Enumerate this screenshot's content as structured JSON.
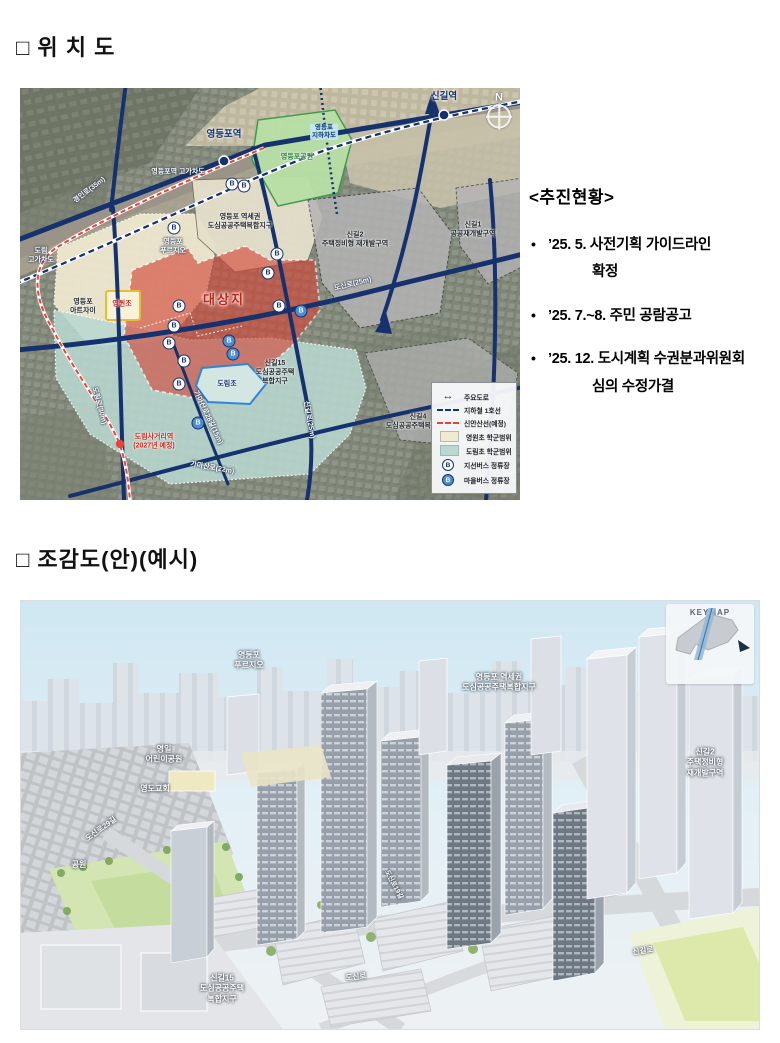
{
  "page": {
    "background": "#ffffff"
  },
  "section1": {
    "title": "□ 위 치 도"
  },
  "section2": {
    "title": "□ 조감도(안)(예시)"
  },
  "status": {
    "heading": "<추진현황>",
    "items": [
      {
        "line1": "’25. 5. 사전기획 가이드라인",
        "line2": "확정"
      },
      {
        "line1": "’25. 7.~8. 주민 공람공고",
        "line2": ""
      },
      {
        "line1": "’25. 12. 도시계획 수권분과위원회",
        "line2": "심의 수정가결"
      }
    ]
  },
  "map": {
    "compass_n": "N",
    "labels": [
      {
        "text": "영등포역"
      },
      {
        "text": "신길역"
      },
      {
        "text": "영등포역 고가차도"
      },
      {
        "text": "경인로(35m)"
      },
      {
        "text": "도림\n고가차도"
      },
      {
        "text": "영등포\n지하차도"
      },
      {
        "text": "영등포공원"
      },
      {
        "text": "영등포 역세권\n도심공공주택복합지구"
      },
      {
        "text": "영등포\n푸르지오"
      },
      {
        "text": "대상지"
      },
      {
        "text": "신길2\n주택정비형 재개발구역"
      },
      {
        "text": "신길1\n공공재개발구역"
      },
      {
        "text": "영원초"
      },
      {
        "text": "도림초"
      },
      {
        "text": "신길15\n도심공공주택\n복합지구"
      },
      {
        "text": "신길4\n도심공공주택복합지구"
      },
      {
        "text": "영등포\n아트자이"
      },
      {
        "text": "도신로(25m)"
      },
      {
        "text": "신길로(25m)"
      },
      {
        "text": "도림로(30m)"
      },
      {
        "text": "가마산로(22m)"
      },
      {
        "text": "가마산로28길(15m)"
      },
      {
        "text": "도림사거리역\n(2027년 예정)"
      }
    ],
    "legend": [
      {
        "icon": "main-road-arrow-icon",
        "label": "주요도로"
      },
      {
        "icon": "subway-dash-icon",
        "label": "지하철 1호선"
      },
      {
        "icon": "sinansan-dash-icon",
        "label": "신안산선(예정)"
      },
      {
        "icon": "cream-swatch-icon",
        "label": "영원초 학군범위"
      },
      {
        "icon": "teal-swatch-icon",
        "label": "도림초 학군범위"
      },
      {
        "icon": "branch-bus-icon",
        "label": "지선버스 정류장"
      },
      {
        "icon": "village-bus-icon",
        "label": "마을버스 정류장"
      }
    ],
    "colors": {
      "main_road": "#16326e",
      "sinansan_line": "#e8433a",
      "site_fill": "#d54436",
      "cream_zone": "#f0ead0",
      "teal_zone": "#b9d8d0",
      "park_green": "#b7e0a6"
    }
  },
  "render3d": {
    "keymap_title": "KEYMAP",
    "labels": [
      {
        "text": "영등포\n푸르지오"
      },
      {
        "text": "영등포 역세권\n도심공공주택복합지구"
      },
      {
        "text": "신길2\n주택정비형\n재개발구역"
      },
      {
        "text": "영일\n어린이공원"
      },
      {
        "text": "영도교회"
      },
      {
        "text": "도신로29길"
      },
      {
        "text": "공원"
      },
      {
        "text": "신길15\n도심공공주택\n복합지구"
      },
      {
        "text": "도신로"
      },
      {
        "text": "신길로"
      },
      {
        "text": "도신로19길"
      }
    ]
  }
}
